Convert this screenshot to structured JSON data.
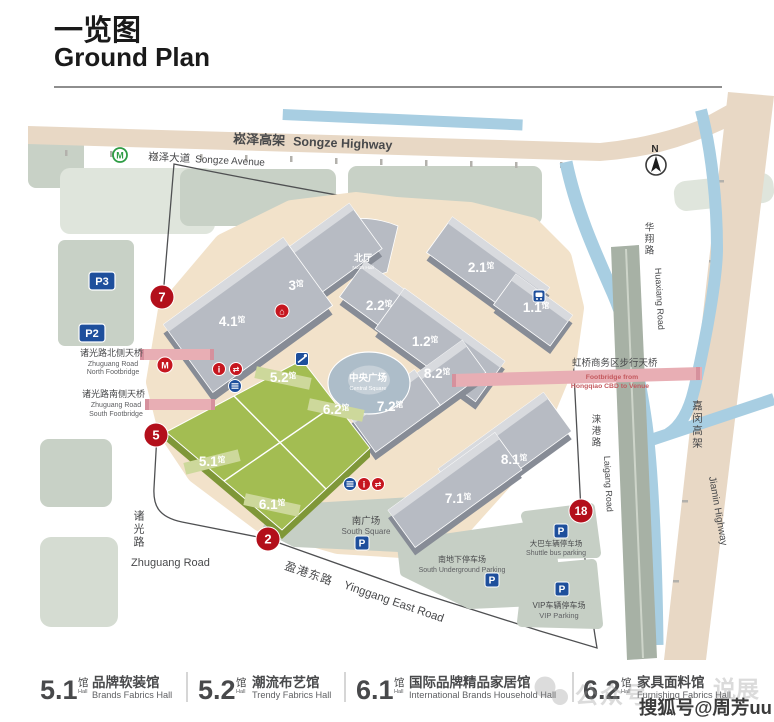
{
  "title": {
    "zh": "一览图",
    "en": "Ground Plan"
  },
  "colors": {
    "hall_gray": "#b7bbc3",
    "hall_gray_side": "#878c96",
    "hall_gray_band": "#d8dade",
    "hall_green": "#a3bd52",
    "hall_green_side": "#7f9738",
    "hall_green_band": "#cdd89b",
    "road_beige": "#e8d8c5",
    "apron_beige": "#f2e2ca",
    "sage": "#c8d1c6",
    "sage_light": "#dfe5dc",
    "river_blue": "#a8cee2",
    "ring_blue": "#adbdc9",
    "ring_inner": "#c6d0d8",
    "footbridge_pink": "#e8aeb4",
    "marker_red": "#b30f1b",
    "icon_blue": "#1e4f9c",
    "icon_red": "#c6161f",
    "metro_green": "#2e9c44",
    "text_dark": "#48494b",
    "text_gray": "#5f6063"
  },
  "compass": {
    "label": "N"
  },
  "roads": {
    "songze_highway_zh": "崧泽高架",
    "songze_highway_en": "Songze Highway",
    "songze_avenue_zh": "崧泽大道",
    "songze_avenue_en": "Songze Avenue",
    "huaxiang_zh": "华翔路",
    "huaxiang_en": "Huaxiang Road",
    "laigang_zh": "涞港路",
    "laigang_en": "Laigang Road",
    "jiamin_zh": "嘉闵高架",
    "jiamin_en": "Jiamin Highway",
    "zhuguang_zh": "诸光路",
    "zhuguang_en": "Zhuguang Road",
    "yinggang_zh": "盈港东路",
    "yinggang_en": "Yinggang East Road"
  },
  "footbridges": {
    "north_zh": "诸光路北侧天桥",
    "north_en1": "Zhuguang Road",
    "north_en2": "North Footbridge",
    "south_zh": "诸光路南侧天桥",
    "south_en1": "Zhuguang Road",
    "south_en2": "South Footbridge",
    "hongqiao_zh": "虹桥商务区步行天桥",
    "hongqiao_en1": "Footbridge from",
    "hongqiao_en2": "Hongqiao CBD to Venue"
  },
  "halls": {
    "h3": "3",
    "h41": "4.1",
    "h22": "2.2",
    "h21": "2.1",
    "h11": "1.1",
    "h12": "1.2",
    "h82": "8.2",
    "h72": "7.2",
    "h81": "8.1",
    "h71": "7.1",
    "h52": "5.2",
    "h62": "6.2",
    "h51": "5.1",
    "h61": "6.1"
  },
  "hall_suffix": "馆",
  "north_hall": {
    "zh": "北厅",
    "en": "North Hall"
  },
  "central_square": {
    "zh": "中央广场",
    "en": "Central Square"
  },
  "areas": {
    "south_square_zh": "南广场",
    "south_square_en": "South Square",
    "underground_zh": "南地下停车场",
    "underground_en": "South Underground Parking",
    "shuttle_zh": "大巴车辆停车场",
    "shuttle_en": "Shuttle bus parking",
    "vip_zh": "VIP车辆停车场",
    "vip_en": "VIP Parking"
  },
  "badges": {
    "p3": "P3",
    "p2": "P2",
    "p": "P"
  },
  "markers": {
    "m7": "7",
    "m5": "5",
    "m2": "2",
    "m18": "18"
  },
  "icons": {
    "metro": "M",
    "info": "i",
    "transfer": "⇄",
    "house": "⌂"
  },
  "legend": [
    {
      "num": "5.1",
      "suffix": "馆",
      "suffix_en": "Hall",
      "zh": "品牌软装馆",
      "en": "Brands Fabrics Hall"
    },
    {
      "num": "5.2",
      "suffix": "馆",
      "suffix_en": "Hall",
      "zh": "潮流布艺馆",
      "en": "Trendy Fabrics Hall"
    },
    {
      "num": "6.1",
      "suffix": "馆",
      "suffix_en": "Hall",
      "zh": "国际品牌精品家居馆",
      "en": "International Brands Household Hall"
    },
    {
      "num": "6.2",
      "suffix": "馆",
      "suffix_en": "Hall",
      "zh": "家具面料馆",
      "en": "Furnishing Fabrics Hall"
    }
  ],
  "watermark": {
    "faint1": "公众号",
    "faint2": "说展",
    "bold": "搜狐号@周芳uu"
  }
}
